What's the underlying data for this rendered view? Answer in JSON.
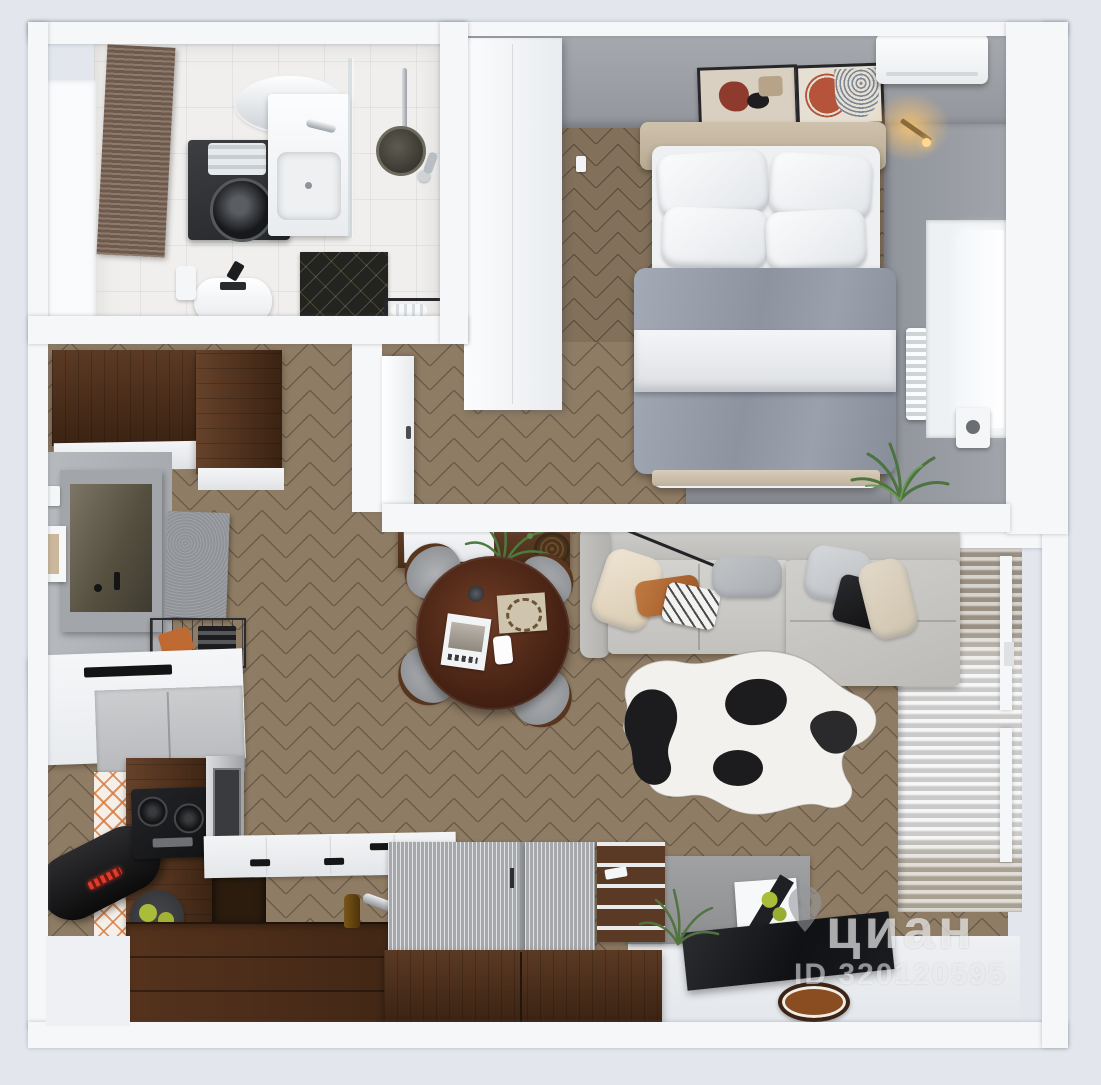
{
  "watermark": {
    "brand": "циан",
    "id": "ID 320120595"
  },
  "palette": {
    "bg": "#e3e7ed",
    "wall": "#f6f7f9",
    "grayWall": "#9da1a8",
    "grayWallDark": "#8e9299",
    "woodMain": "#8f7c64",
    "woodBedroom": "#83705a",
    "walnut": "#5b3a24",
    "walnutDark": "#3a2212",
    "tile": "#f0efed",
    "sofa": "#c8c7c4",
    "duvet": "#9aa1ad",
    "mattress": "#eef0f2",
    "headboard": "#c9bba6",
    "curtainTaupe": "#a79d90",
    "curtainSheer": "#eceef0",
    "tv": "#17181b",
    "accentOrange": "#c06a33",
    "plantGreen": "#55793f",
    "appleGreen": "#a9bd3a",
    "rugWhite": "#f2f1ed",
    "rugBlack": "#1c1c1e"
  }
}
